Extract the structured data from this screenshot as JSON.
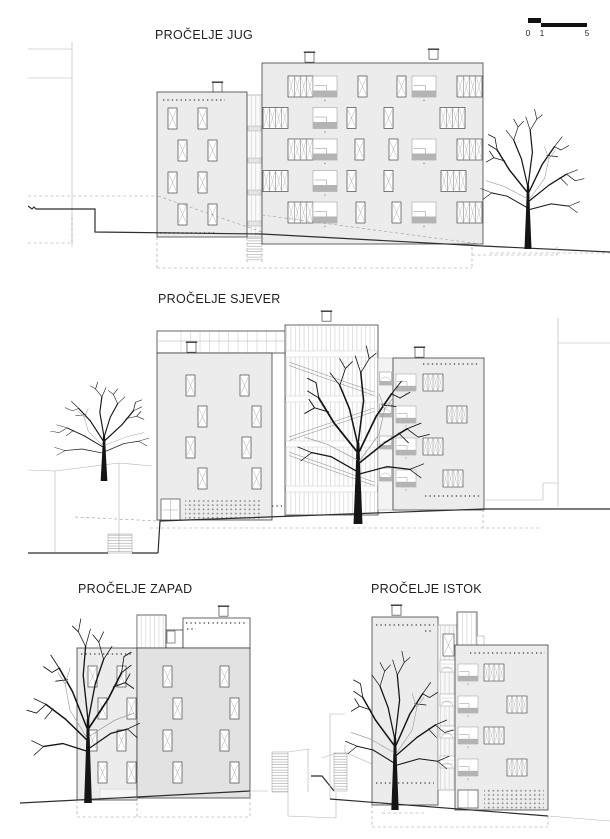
{
  "sheet": {
    "titles": {
      "south": "PROČELJE JUG",
      "north": "PROČELJE SJEVER",
      "west": "PROČELJE ZAPAD",
      "east": "PROČELJE ISTOK"
    },
    "scale_bar": {
      "labels": [
        "0",
        "1",
        "5"
      ]
    },
    "colors": {
      "facade_light": "#ececec",
      "facade_mid": "#e2e2e2",
      "loggia_gray": "#b4b4b4",
      "line_dark": "#3f3f3f",
      "line_light": "#b3b3b3",
      "tree": "#151515"
    }
  }
}
